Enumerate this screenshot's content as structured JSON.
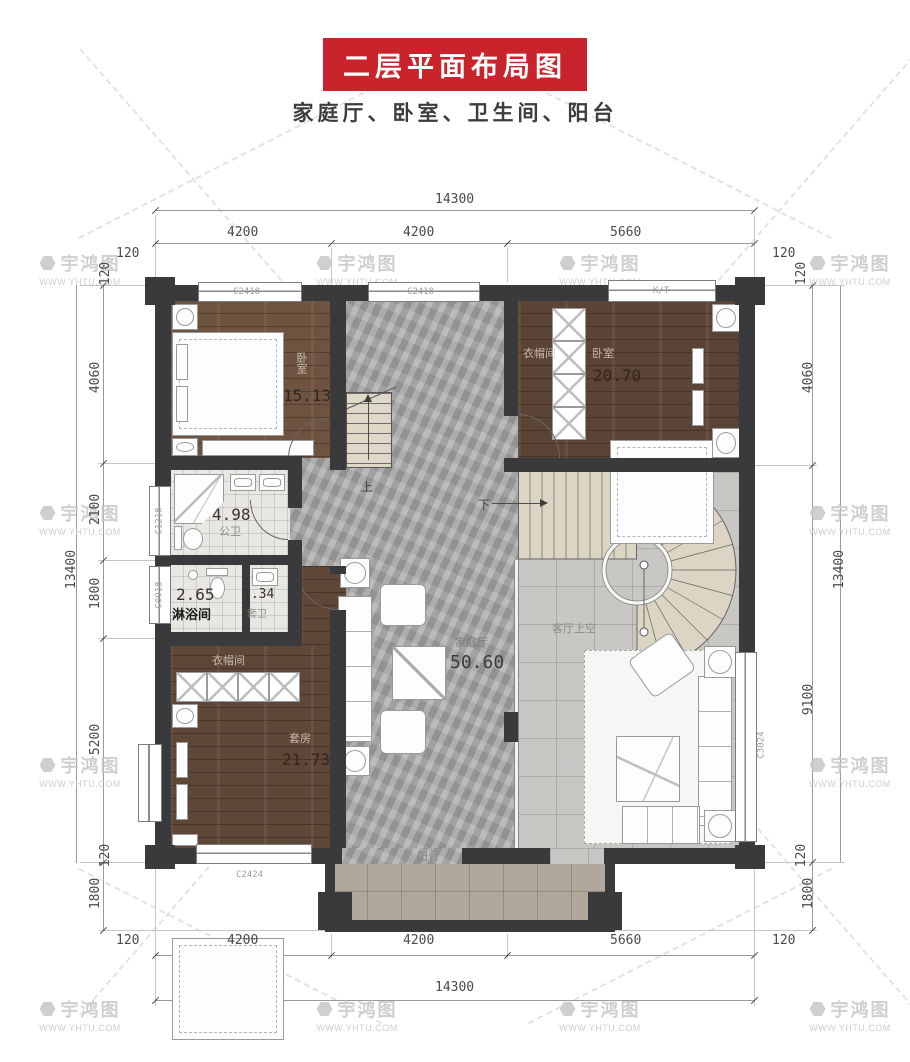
{
  "title": {
    "banner": "二层平面布局图",
    "subtitle": "家庭厅、卧室、卫生间、阳台"
  },
  "watermark": {
    "brand": "宇鸿图",
    "url": "WWW.YHTU.COM"
  },
  "dims": {
    "top": {
      "total": "14300",
      "seg": [
        "4200",
        "4200",
        "5660"
      ],
      "edge_l": "120",
      "edge_r": "120"
    },
    "bottom": {
      "total": "14300",
      "seg": [
        "4200",
        "4200",
        "5660"
      ],
      "edge_l": "120",
      "edge_r": "120"
    },
    "left": {
      "total": "13400",
      "wall_t": "120",
      "seg": [
        "4060",
        "2100",
        "1800",
        "5200"
      ],
      "wall_b": "120",
      "balc": "1800"
    },
    "right": {
      "total": "13400",
      "wall_t": "120",
      "seg": [
        "4060",
        "9100"
      ],
      "wall_b": "120",
      "balc": "1800"
    }
  },
  "rooms": {
    "bedroom_tl": {
      "name": "卧室",
      "area": "15.13"
    },
    "bedroom_tr": {
      "name": "卧室",
      "area": "20.70",
      "closet": "衣帽间"
    },
    "bath": {
      "name": "公卫",
      "area": "4.98"
    },
    "shower": {
      "name": "淋浴间",
      "area": "2.65"
    },
    "ensuite": {
      "name": "套卫",
      "area": "1.34"
    },
    "suite": {
      "name": "套房",
      "area": "21.73",
      "closet": "衣帽间"
    },
    "hall": {
      "name": "家庭厅",
      "area": "50.60"
    },
    "void": {
      "name": "客厅上空"
    },
    "balcony": {
      "name": "阳台"
    },
    "stair_up": {
      "label": "上"
    },
    "stair_down": {
      "label": "下"
    }
  },
  "windows": {
    "top_left": "C2418",
    "top_mid": "C2418",
    "top_right": "K/T",
    "left_upper": "C1218",
    "left_lower": "C0918",
    "bottom": "C2424",
    "right": "C3024"
  }
}
